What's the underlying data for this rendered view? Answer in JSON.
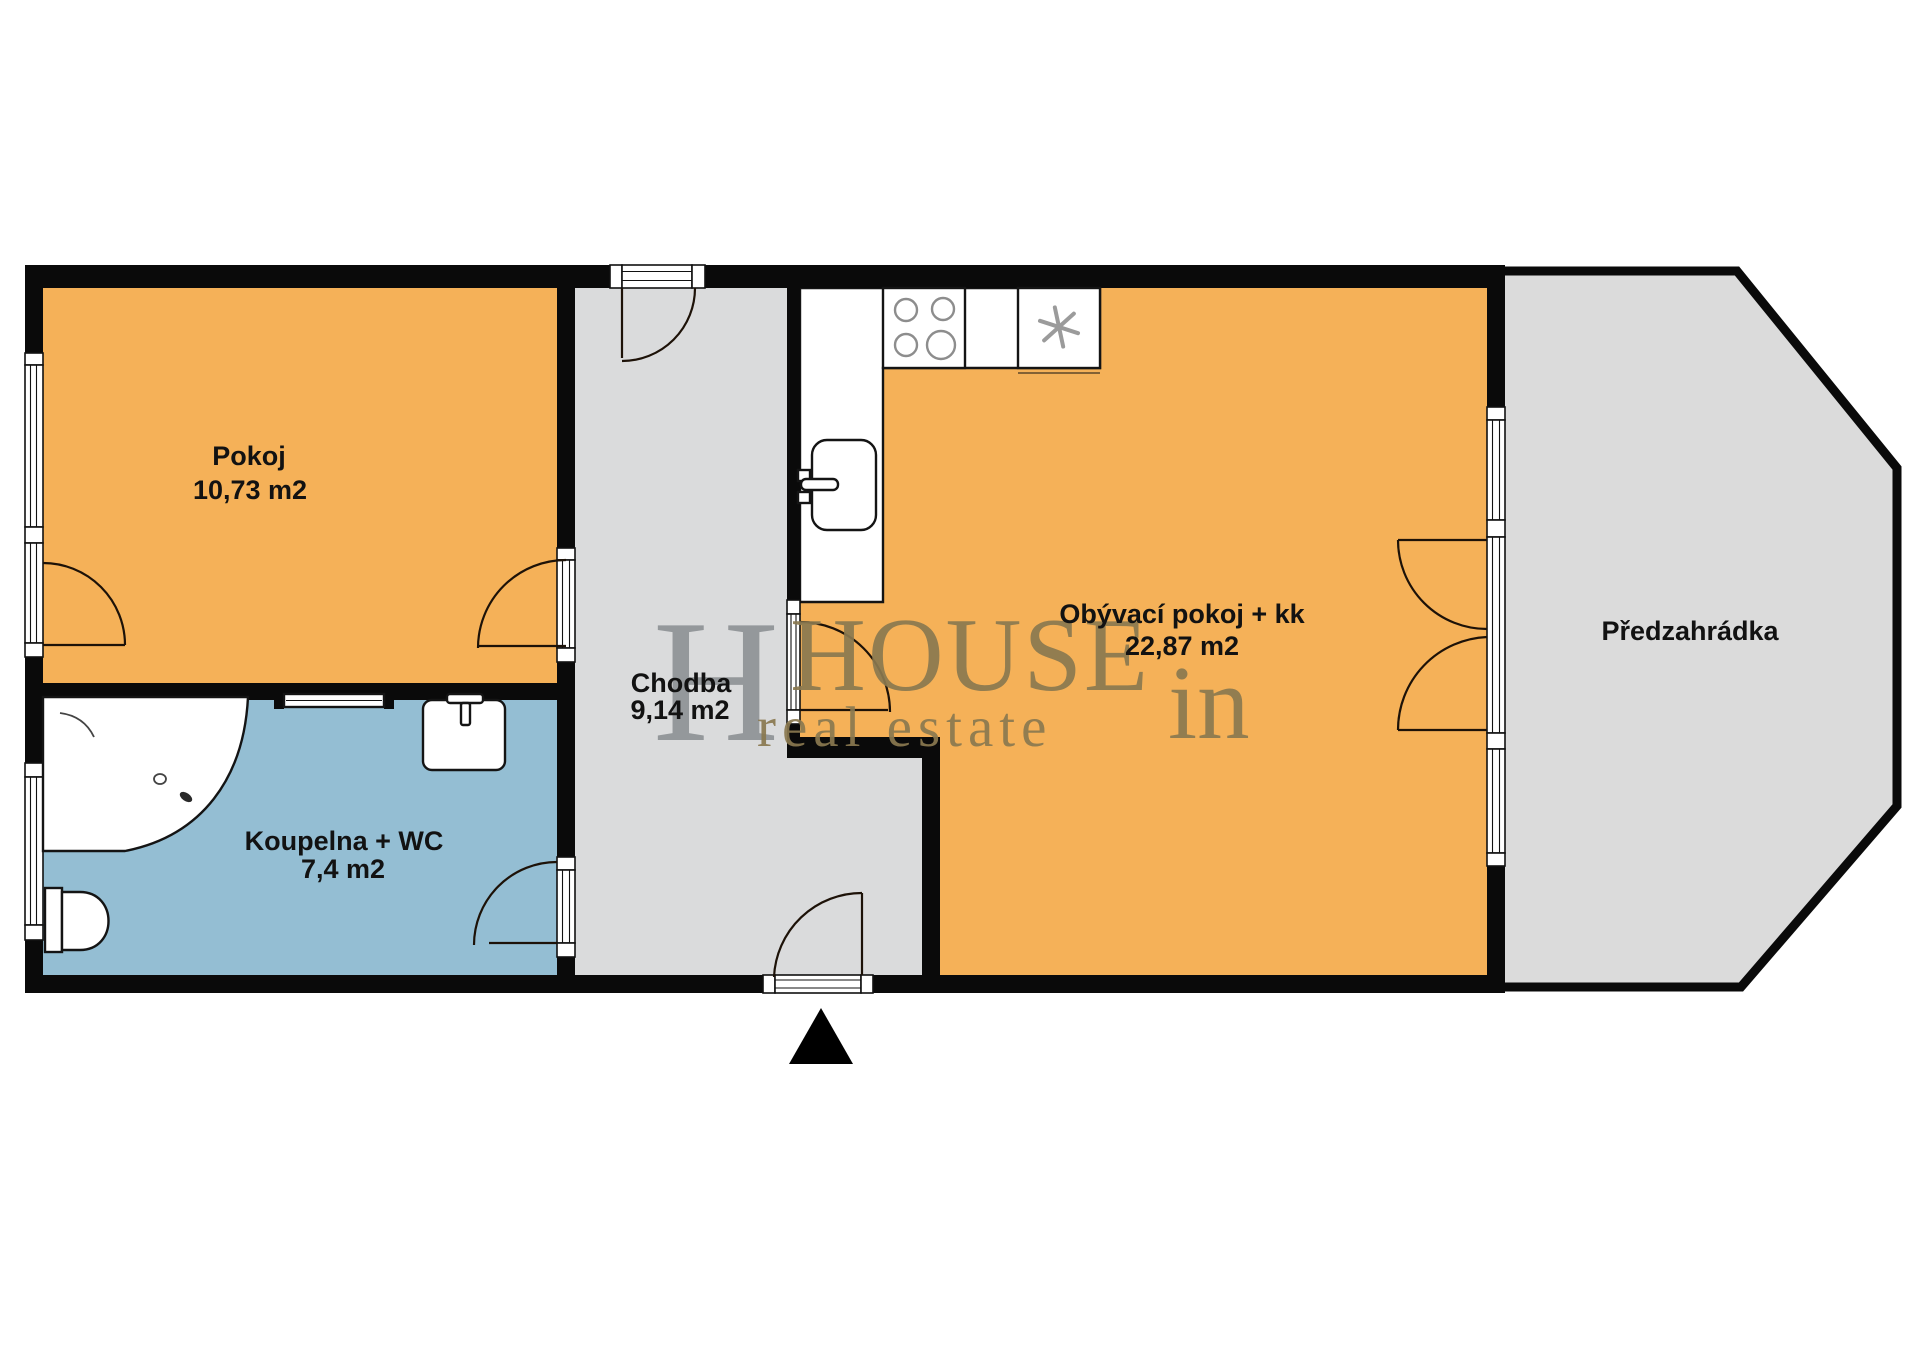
{
  "rooms": {
    "pokoj": {
      "name": "Pokoj",
      "area": "10,73 m2"
    },
    "koupelna": {
      "name": "Koupelna + WC",
      "area": "7,4 m2"
    },
    "chodba": {
      "name": "Chodba",
      "area": "9,14 m2"
    },
    "obyvaci": {
      "name": "Obývací pokoj + kk",
      "area": "22,87 m2"
    },
    "predzahradka": {
      "name": "Předzahrádka"
    }
  },
  "watermark": {
    "monogram": "H",
    "brand_caps": "HOUSE",
    "brand_suffix": "in",
    "tagline": "real estate"
  },
  "colors": {
    "room_orange": "#F5B158",
    "bathroom_blue": "#94BED3",
    "hall_gray": "#DADBDC",
    "garden_gray": "#DBDBDB",
    "wall_black": "#0A0A0A",
    "watermark_tan": "#8A7950",
    "monogram_gray": "#8D9194"
  }
}
